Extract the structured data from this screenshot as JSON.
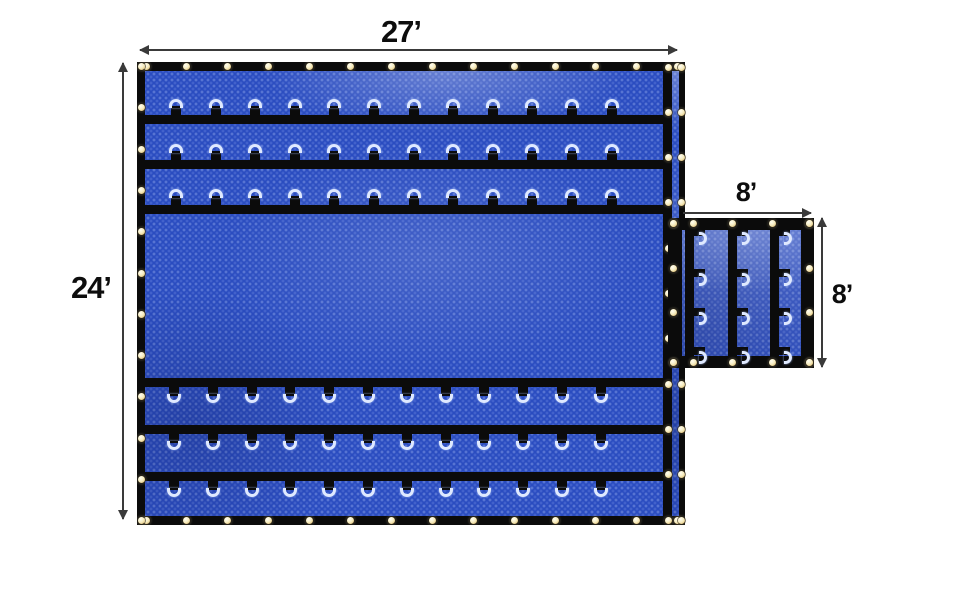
{
  "diagram": {
    "product": "Blue heavy-duty tarp with D-ring rows, gold grommets and attached side flap",
    "colors": {
      "tarp_blue": "#2a4cc0",
      "webbing_black": "#0b0b0b",
      "d_ring_silver": "#dfe9ff",
      "grommet_gold": "#f6ebbe",
      "dimension_line": "#3a3a3a",
      "label_text": "#0d0d0d",
      "background": "#ffffff"
    },
    "dimensions": {
      "main_width_label": "27’",
      "main_height_label": "24’",
      "flap_width_label": "8’",
      "flap_height_label": "8’"
    },
    "main_tarp": {
      "d_ring_rows_top": 3,
      "d_ring_rows_bottom": 3,
      "d_rings_per_row": 12,
      "grommet_counts": {
        "top": 14,
        "bottom": 14,
        "left": 12,
        "right_inner": 11,
        "right_outer": 11
      }
    },
    "side_flap": {
      "webbing_strips": 3,
      "d_rings_per_strip": 4,
      "grommet_counts": {
        "top": 5,
        "bottom": 5,
        "left": 4,
        "right": 4
      }
    }
  }
}
